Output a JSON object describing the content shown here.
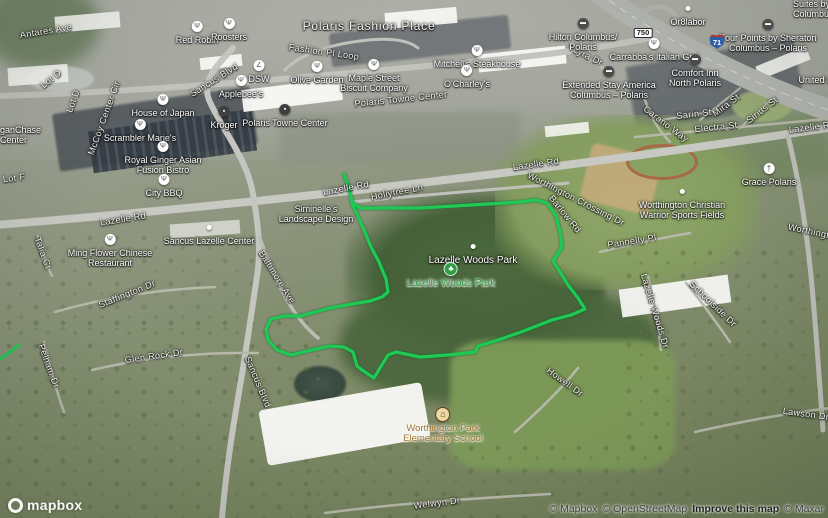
{
  "map": {
    "type": "satellite-aerial",
    "park_outline": {
      "color": "#1fca54",
      "points": [
        [
          344,
          174
        ],
        [
          349,
          188
        ],
        [
          352,
          202
        ],
        [
          360,
          208
        ],
        [
          420,
          208
        ],
        [
          455,
          206
        ],
        [
          520,
          202
        ],
        [
          536,
          200
        ],
        [
          547,
          203
        ],
        [
          556,
          216
        ],
        [
          560,
          232
        ],
        [
          562,
          247
        ],
        [
          553,
          261
        ],
        [
          560,
          272
        ],
        [
          568,
          285
        ],
        [
          578,
          298
        ],
        [
          585,
          309
        ],
        [
          571,
          315
        ],
        [
          552,
          320
        ],
        [
          521,
          332
        ],
        [
          495,
          341
        ],
        [
          478,
          346
        ],
        [
          475,
          352
        ],
        [
          448,
          355
        ],
        [
          420,
          357
        ],
        [
          396,
          352
        ],
        [
          388,
          355
        ],
        [
          380,
          368
        ],
        [
          374,
          378
        ],
        [
          362,
          370
        ],
        [
          357,
          366
        ],
        [
          353,
          352
        ],
        [
          344,
          347
        ],
        [
          330,
          346
        ],
        [
          312,
          350
        ],
        [
          291,
          355
        ],
        [
          277,
          350
        ],
        [
          268,
          340
        ],
        [
          266,
          329
        ],
        [
          271,
          319
        ],
        [
          284,
          316
        ],
        [
          300,
          316
        ],
        [
          330,
          308
        ],
        [
          352,
          304
        ],
        [
          370,
          301
        ],
        [
          382,
          297
        ],
        [
          388,
          292
        ],
        [
          386,
          279
        ],
        [
          379,
          262
        ],
        [
          371,
          247
        ],
        [
          364,
          230
        ],
        [
          357,
          214
        ],
        [
          352,
          204
        ]
      ]
    },
    "park_outline_fragment": [
      [
        0,
        359
      ],
      [
        10,
        352
      ],
      [
        19,
        345
      ]
    ]
  },
  "icon_styles": {
    "restaurant": {
      "bg": "#ffffff",
      "fg": "#4f4f4f",
      "glyph": "Ψ",
      "size": 11,
      "fs": 7
    },
    "hotel": {
      "bg": "#4b4b4b",
      "fg": "#ffffff",
      "glyph": "▬",
      "size": 11,
      "fs": 6
    },
    "shop": {
      "bg": "#3f3f3f",
      "fg": "#ffffff",
      "glyph": "▪",
      "size": 11,
      "fs": 7
    },
    "shoe": {
      "bg": "#ffffff",
      "fg": "#4f4f4f",
      "glyph": "∠",
      "size": 11,
      "fs": 7
    },
    "church": {
      "bg": "#ffffff",
      "fg": "#3f3f3f",
      "glyph": "†",
      "size": 11,
      "fs": 8
    },
    "school": {
      "bg": "#edd9a8",
      "fg": "#5f430f",
      "glyph": "⌂",
      "size": 13,
      "fs": 9,
      "border": "#5f430f"
    },
    "park": {
      "bg": "#2f9e44",
      "fg": "#ffffff",
      "glyph": "♣",
      "size": 12,
      "fs": 8,
      "border": "#d9efdc"
    },
    "dot": {
      "bg": "#ffffff",
      "fg": "#ffffff",
      "glyph": "",
      "size": 5
    }
  },
  "labels": {
    "areas": [
      {
        "text": "Polaris Fashion Place",
        "x": 369,
        "y": 26,
        "size": 12
      }
    ],
    "roads": [
      {
        "text": "Antares Ave",
        "x": 46,
        "y": 31,
        "rot": -9
      },
      {
        "text": "Lot D",
        "x": 51,
        "y": 79,
        "rot": -38
      },
      {
        "text": "Lot D",
        "x": 73,
        "y": 101,
        "rot": -70
      },
      {
        "text": "McCoy Center Cir",
        "x": 104,
        "y": 118,
        "rot": -70
      },
      {
        "text": "Lot F",
        "x": 14,
        "y": 178,
        "rot": -8
      },
      {
        "text": "Sancus Blvd",
        "x": 214,
        "y": 80,
        "rot": -32
      },
      {
        "text": "Fashion Pl Loop",
        "x": 324,
        "y": 52,
        "rot": 8
      },
      {
        "text": "Lyra Dr",
        "x": 588,
        "y": 56,
        "rot": 27
      },
      {
        "text": "Mira St",
        "x": 726,
        "y": 105,
        "rot": -37
      },
      {
        "text": "Sirius St",
        "x": 762,
        "y": 110,
        "rot": -38
      },
      {
        "text": "Sarin St",
        "x": 694,
        "y": 114,
        "rot": -7
      },
      {
        "text": "Electra St",
        "x": 716,
        "y": 127,
        "rot": -6
      },
      {
        "text": "Carano Way",
        "x": 666,
        "y": 124,
        "rot": 37
      },
      {
        "text": "Lazelle Rd",
        "x": 812,
        "y": 127,
        "rot": -7
      },
      {
        "text": "Lazelle Rd",
        "x": 123,
        "y": 219,
        "rot": -9
      },
      {
        "text": "Lazelle Rd",
        "x": 346,
        "y": 188,
        "rot": -10
      },
      {
        "text": "Lazelle Rd",
        "x": 536,
        "y": 164,
        "rot": -8
      },
      {
        "text": "Hollytree Ln",
        "x": 397,
        "y": 192,
        "rot": -11
      },
      {
        "text": "Talia Ct",
        "x": 43,
        "y": 253,
        "rot": 70
      },
      {
        "text": "Baltimore Ave",
        "x": 277,
        "y": 277,
        "rot": 58
      },
      {
        "text": "Staffington Dr",
        "x": 127,
        "y": 294,
        "rot": -22
      },
      {
        "text": "Worthington Crossing Dr",
        "x": 576,
        "y": 199,
        "rot": 27
      },
      {
        "text": "Barlow Rd",
        "x": 565,
        "y": 214,
        "rot": 51
      },
      {
        "text": "Pannelly Pl",
        "x": 632,
        "y": 241,
        "rot": -9
      },
      {
        "text": "Lazelle Woods Dr",
        "x": 655,
        "y": 311,
        "rot": 73
      },
      {
        "text": "Schoolside Dr",
        "x": 713,
        "y": 304,
        "rot": 44
      },
      {
        "text": "Glen Rock Dr",
        "x": 154,
        "y": 356,
        "rot": -8
      },
      {
        "text": "Pelham Dr",
        "x": 49,
        "y": 366,
        "rot": 70
      },
      {
        "text": "Sancus Blvd",
        "x": 258,
        "y": 382,
        "rot": 67
      },
      {
        "text": "Howell Dr",
        "x": 565,
        "y": 382,
        "rot": 36
      },
      {
        "text": "Lawson Dr",
        "x": 806,
        "y": 414,
        "rot": 8
      },
      {
        "text": "Worthington",
        "x": 814,
        "y": 232,
        "rot": 12
      },
      {
        "text": "Welwyn Dr",
        "x": 437,
        "y": 503,
        "rot": -7
      },
      {
        "text": "Polaris Towne Center",
        "x": 401,
        "y": 99,
        "rot": -6
      }
    ],
    "pois": [
      {
        "name": "red-robin",
        "icon": "restaurant",
        "x": 197,
        "top": 18,
        "lines": [
          "Red Robin"
        ]
      },
      {
        "name": "roosters",
        "icon": "restaurant",
        "x": 229,
        "top": 15,
        "lines": [
          "Roosters"
        ]
      },
      {
        "name": "dsw",
        "icon": "shoe",
        "x": 259,
        "top": 57,
        "lines": [
          "DSW"
        ]
      },
      {
        "name": "applebees",
        "icon": "restaurant",
        "x": 241,
        "top": 72,
        "lines": [
          "Applebee's"
        ]
      },
      {
        "name": "kroger",
        "icon": "shop",
        "x": 224,
        "top": 103,
        "lines": [
          "Kroger"
        ]
      },
      {
        "name": "house-of-japan",
        "icon": "restaurant",
        "x": 163,
        "top": 91,
        "lines": [
          "House of Japan"
        ]
      },
      {
        "name": "scrambler-maries",
        "icon": "restaurant",
        "x": 140,
        "top": 116,
        "lines": [
          "Scrambler Marie's"
        ]
      },
      {
        "name": "royal-ginger",
        "icon": "restaurant",
        "x": 163,
        "top": 138,
        "lines": [
          "Royal Ginger Asian",
          "Fusion Bistro"
        ]
      },
      {
        "name": "city-bbq",
        "icon": "restaurant",
        "x": 164,
        "top": 171,
        "lines": [
          "City BBQ"
        ]
      },
      {
        "name": "ming-flower",
        "icon": "restaurant",
        "x": 110,
        "top": 231,
        "lines": [
          "Ming Flower Chinese",
          "Restaurant"
        ]
      },
      {
        "name": "olive-garden",
        "icon": "restaurant",
        "x": 317,
        "top": 58,
        "lines": [
          "Olive Garden"
        ]
      },
      {
        "name": "maple-street-biscuit",
        "icon": "restaurant",
        "x": 374,
        "top": 56,
        "lines": [
          "Maple Street",
          "Biscuit Company"
        ]
      },
      {
        "name": "mitchells-steakhouse",
        "icon": "restaurant",
        "x": 477,
        "top": 42,
        "lines": [
          "Mitchell's Steakhouse"
        ]
      },
      {
        "name": "ocharleys",
        "icon": "restaurant",
        "x": 467,
        "top": 62,
        "lines": [
          "O'Charley's"
        ]
      },
      {
        "name": "carrabbas",
        "icon": "restaurant",
        "x": 654,
        "top": 35,
        "lines": [
          "Carrabba's Italian Grill"
        ]
      },
      {
        "name": "orblabor",
        "icon": "dot",
        "x": 688,
        "top": 0,
        "lines": [
          "Or8labor"
        ]
      },
      {
        "name": "hilton",
        "icon": "hotel",
        "x": 583,
        "top": 15,
        "lines": [
          "Hilton Columbus/",
          "Polaris"
        ]
      },
      {
        "name": "four-points-sheraton",
        "icon": "hotel",
        "x": 768,
        "top": 16,
        "lines": [
          "Four Points by Sheraton",
          "Columbus – Polaris"
        ]
      },
      {
        "name": "comfort-inn",
        "icon": "hotel",
        "x": 695,
        "top": 51,
        "lines": [
          "Comfort Inn",
          "North Polaris"
        ]
      },
      {
        "name": "extended-stay",
        "icon": "hotel",
        "x": 609,
        "top": 63,
        "lines": [
          "Extended Stay America",
          "Columbus – Polaris"
        ]
      },
      {
        "name": "united-partial",
        "x": 816,
        "top": 76,
        "lines": [
          "United H"
        ]
      },
      {
        "name": "suites-partial",
        "left": 793,
        "top": 0,
        "lines": [
          "Suites by Hi",
          "Columbus/Po"
        ]
      },
      {
        "name": "jpmorgan-partial",
        "left": 0,
        "top": 126,
        "lines": [
          "ganChase",
          "Center"
        ]
      },
      {
        "name": "grace-polaris",
        "icon": "church",
        "x": 769,
        "top": 160,
        "lines": [
          "Grace Polaris"
        ]
      },
      {
        "name": "worthington-christian-fields",
        "icon": "dot",
        "x": 682,
        "top": 183,
        "lines": [
          "Worthington Christian",
          "Warrior Sports Fields"
        ]
      },
      {
        "name": "polaris-towne-center",
        "icon": "shop",
        "x": 285,
        "top": 101,
        "lines": [
          "Polaris Towne Center"
        ]
      },
      {
        "name": "sancus-lazelle-center",
        "icon": "dot",
        "x": 209,
        "top": 219,
        "lines": [
          "Sancus Lazelle Center"
        ]
      },
      {
        "name": "siminelles-landscape",
        "x": 316,
        "top": 205,
        "lines": [
          "Siminelle's",
          "Landscape Design"
        ]
      },
      {
        "name": "lazelle-woods-park-area",
        "icon": "dot",
        "x": 473,
        "top": 238,
        "lines": [
          "Lazelle Woods Park"
        ],
        "size": 10
      },
      {
        "name": "lazelle-woods-park",
        "icon": "park",
        "x": 451,
        "top": 261,
        "lines": [
          "Lazelle Woods Park"
        ],
        "color": "#2f9e44",
        "halo": "light",
        "size": 10
      },
      {
        "name": "worthington-park-elementary",
        "icon": "school",
        "x": 443,
        "top": 406,
        "lines": [
          "Worthington Park",
          "Elementary School"
        ],
        "color": "#a0742a",
        "halo": "light",
        "size": 9.5
      }
    ],
    "shields": [
      {
        "type": "route",
        "text": "750",
        "x": 643,
        "y": 33
      },
      {
        "type": "interstate",
        "text": "71",
        "x": 717,
        "y": 41
      }
    ]
  },
  "logo": {
    "text": "mapbox"
  },
  "attribution": {
    "items": [
      {
        "text": "© Mapbox",
        "link": true,
        "strong": false
      },
      {
        "text": "© OpenStreetMap",
        "link": true,
        "strong": false
      },
      {
        "text": "Improve this map",
        "link": true,
        "strong": true
      },
      {
        "text": "© Maxar",
        "link": true,
        "strong": false
      }
    ]
  }
}
